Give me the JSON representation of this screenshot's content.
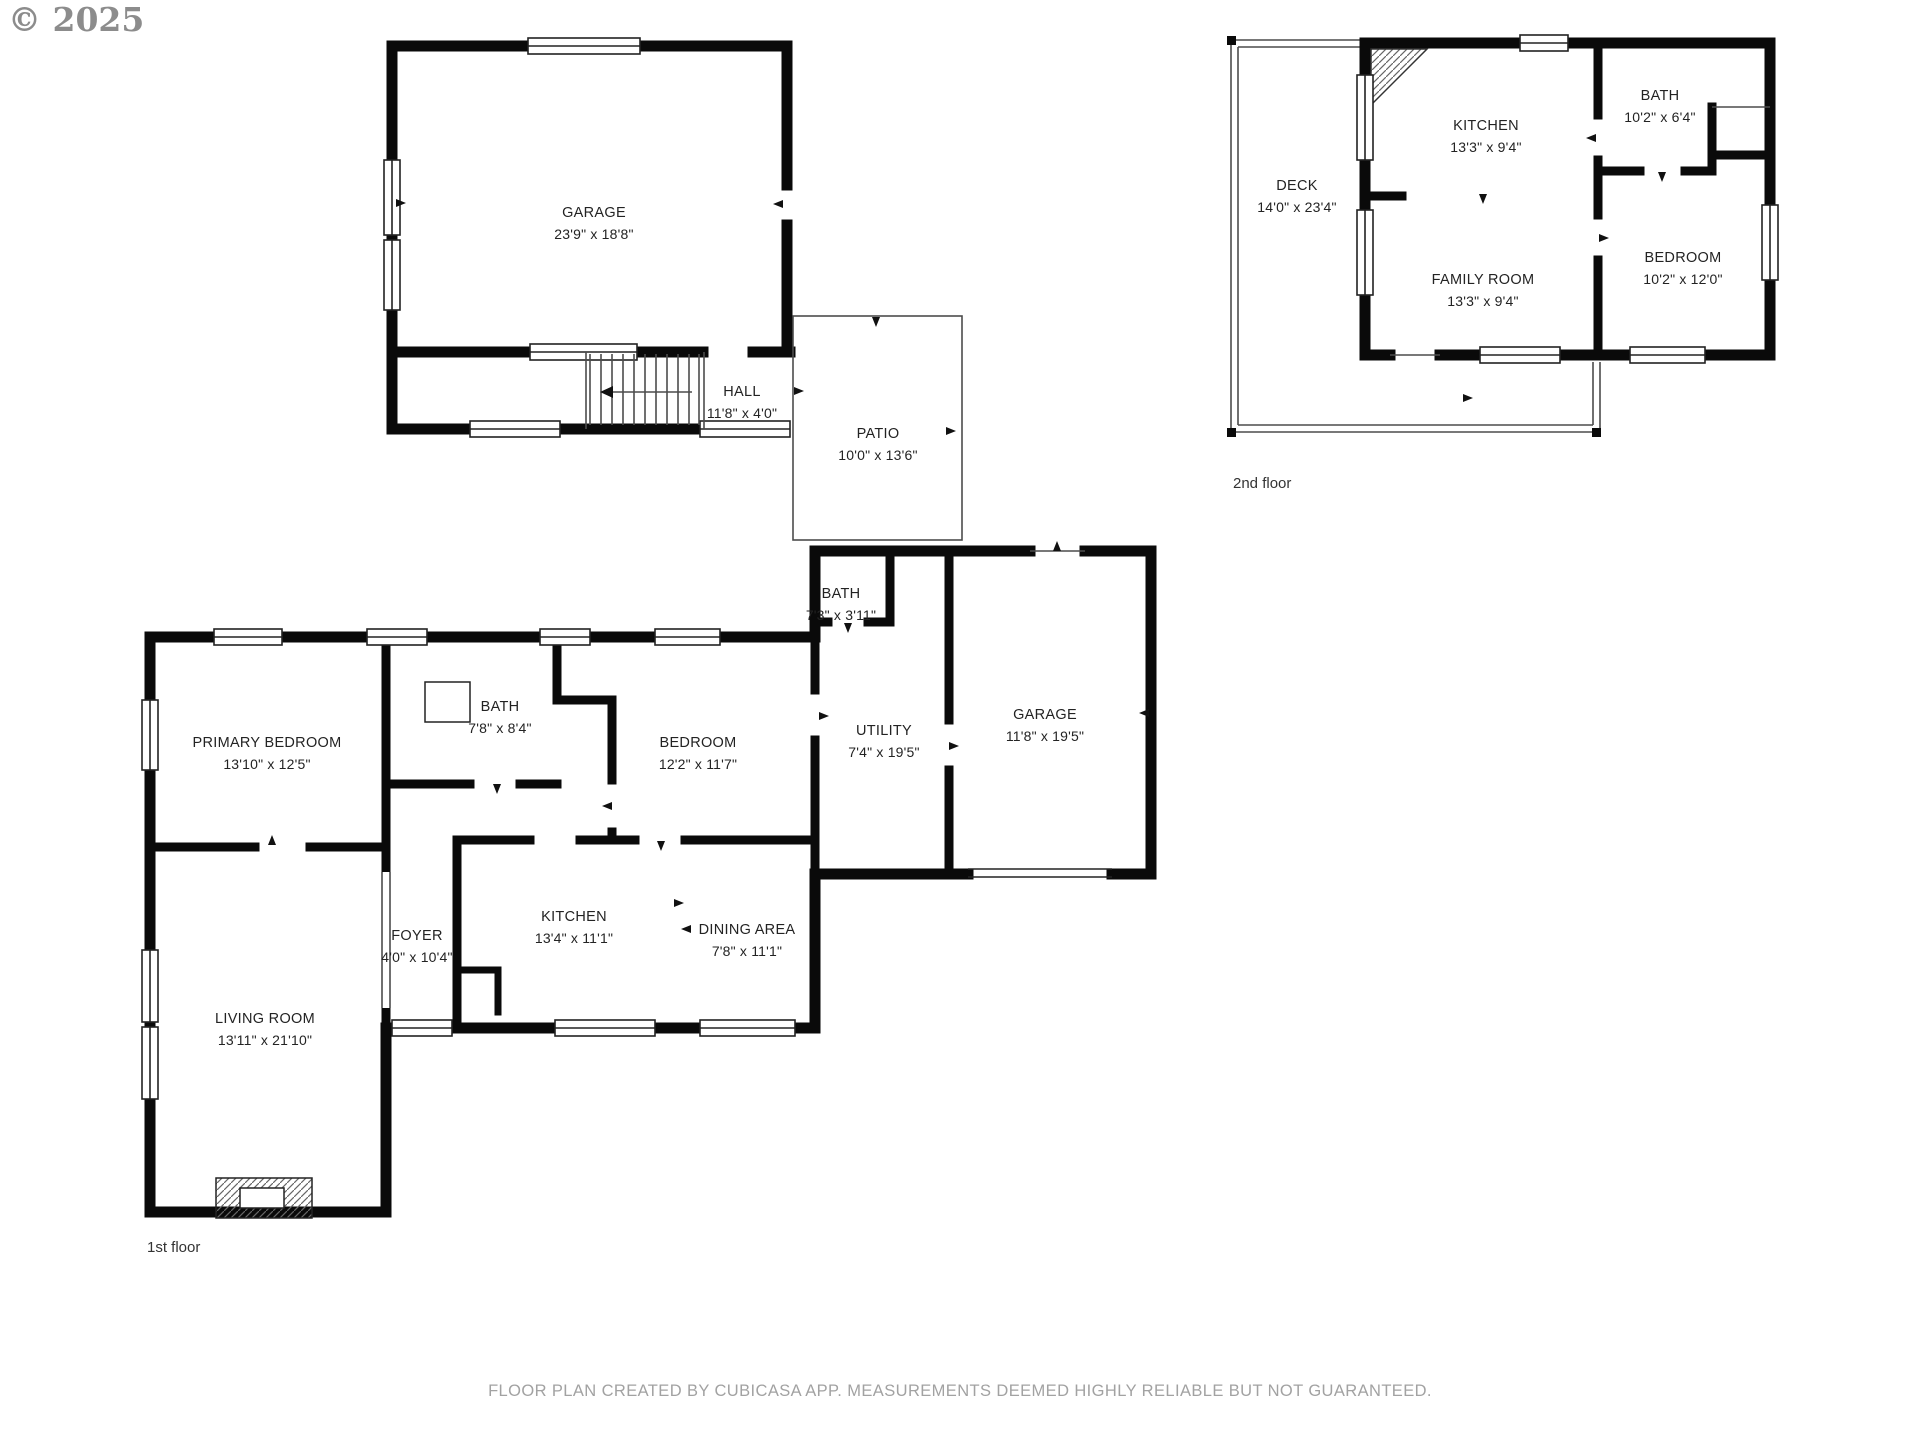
{
  "copyright": "© 2025",
  "footer": "FLOOR PLAN CREATED BY CUBICASA APP. MEASUREMENTS DEEMED HIGHLY RELIABLE BUT NOT GUARANTEED.",
  "colors": {
    "wall": "#0a0a0a",
    "label_text": "#232323",
    "muted_text": "#a2a2a2"
  },
  "first_floor": {
    "label": "1st floor",
    "rooms": {
      "garage_upper": {
        "name": "GARAGE",
        "dims": "23'9\" x 18'8\""
      },
      "hall": {
        "name": "HALL",
        "dims": "11'8\" x 4'0\""
      },
      "patio": {
        "name": "PATIO",
        "dims": "10'0\" x 13'6\""
      },
      "bath_small": {
        "name": "BATH",
        "dims": "7'3\" x 3'11\""
      },
      "primary_bedroom": {
        "name": "PRIMARY BEDROOM",
        "dims": "13'10\" x 12'5\""
      },
      "bath": {
        "name": "BATH",
        "dims": "7'8\" x 8'4\""
      },
      "bedroom": {
        "name": "BEDROOM",
        "dims": "12'2\" x 11'7\""
      },
      "utility": {
        "name": "UTILITY",
        "dims": "7'4\" x 19'5\""
      },
      "garage": {
        "name": "GARAGE",
        "dims": "11'8\" x 19'5\""
      },
      "kitchen": {
        "name": "KITCHEN",
        "dims": "13'4\" x 11'1\""
      },
      "dining": {
        "name": "DINING AREA",
        "dims": "7'8\" x 11'1\""
      },
      "foyer": {
        "name": "FOYER",
        "dims": "4'0\" x 10'4\""
      },
      "living_room": {
        "name": "LIVING ROOM",
        "dims": "13'11\" x 21'10\""
      }
    }
  },
  "second_floor": {
    "label": "2nd floor",
    "rooms": {
      "deck": {
        "name": "DECK",
        "dims": "14'0\" x 23'4\""
      },
      "kitchen": {
        "name": "KITCHEN",
        "dims": "13'3\" x 9'4\""
      },
      "bath": {
        "name": "BATH",
        "dims": "10'2\" x 6'4\""
      },
      "family_room": {
        "name": "FAMILY ROOM",
        "dims": "13'3\" x 9'4\""
      },
      "bedroom": {
        "name": "BEDROOM",
        "dims": "10'2\" x 12'0\""
      }
    }
  }
}
